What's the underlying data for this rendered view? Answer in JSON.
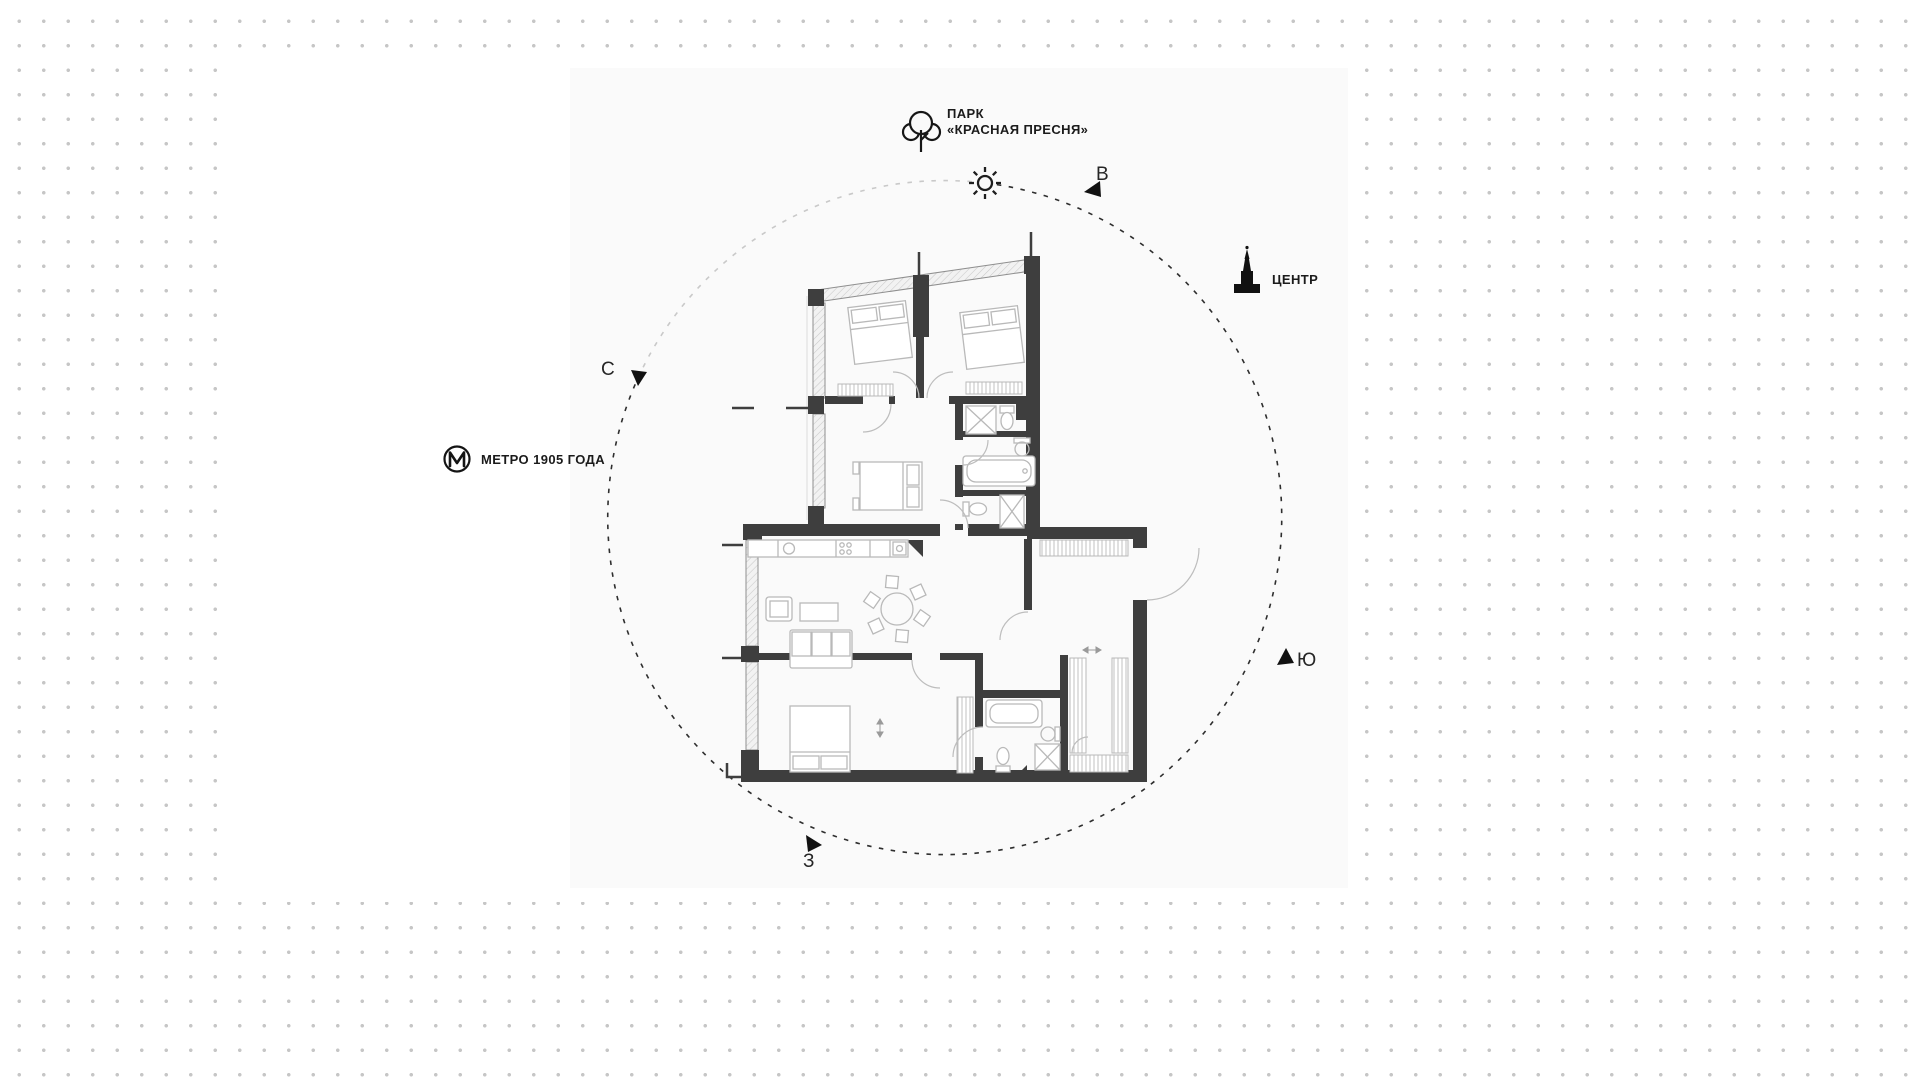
{
  "landmarks": {
    "park": {
      "icon": "tree-icon",
      "line1": "ПАРК",
      "line2": "«КРАСНАЯ ПРЕСНЯ»"
    },
    "center": {
      "icon": "kremlin-tower-icon",
      "label": "ЦЕНТР"
    },
    "metro": {
      "icon": "metro-logo-icon",
      "label": "МЕТРО 1905 ГОДА"
    }
  },
  "compass": {
    "east": "В",
    "north": "С",
    "south": "Ю",
    "west": "З"
  },
  "theme": {
    "dot_color": "#c6c6c6",
    "card_bg": "#ffffff",
    "plan_area_bg": "#fafafa",
    "wall_color": "#3e3e3e",
    "furniture_color": "#b9b9b9",
    "circle_dash_color": "#2e2e2e",
    "circle_light_dash_color": "#c9c9c9",
    "text_color": "#1b1b1b"
  }
}
